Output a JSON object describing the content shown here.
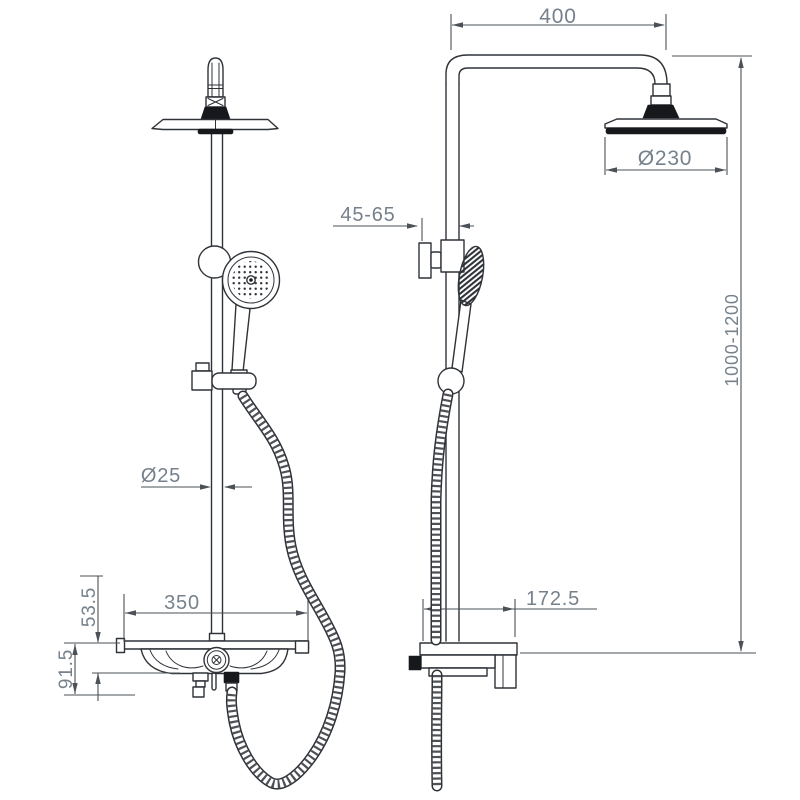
{
  "dims": {
    "arm_width": "400",
    "head_diameter": "Ø230",
    "bracket_range": "45-65",
    "height_range": "1000-1200",
    "shelf_depth": "172.5",
    "pipe_diameter": "Ø25",
    "shelf_width": "350",
    "tray_height": "53.5",
    "body_height": "91.5"
  },
  "colors": {
    "line": "#2f3338",
    "dim_line": "#4b5157",
    "text": "#76818c",
    "fill_dark": "#17181c",
    "bg": "#ffffff"
  }
}
